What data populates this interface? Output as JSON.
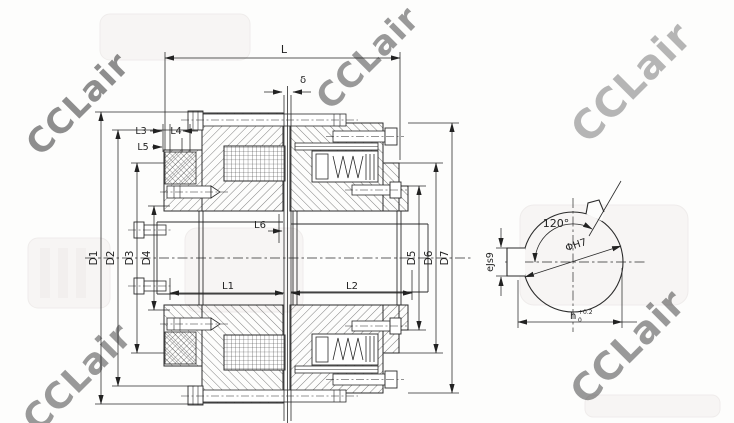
{
  "watermark": {
    "text": "CCLair",
    "color": "#b9a2a2"
  },
  "main_view": {
    "labels": {
      "L": "L",
      "delta": "δ",
      "L1": "L1",
      "L2": "L2",
      "L3": "L3",
      "L4": "L4",
      "L5": "L5",
      "L6": "L6",
      "D1": "D1",
      "D2": "D2",
      "D3": "D3",
      "D4": "D4",
      "D5": "D5",
      "D6": "D6",
      "D7": "D7"
    }
  },
  "side_view": {
    "labels": {
      "angle": "120°",
      "bore": "ΦH7",
      "key_width": "eJs9",
      "key_depth": "h",
      "tol_upper": "+0.2",
      "tol_lower": "0"
    }
  }
}
